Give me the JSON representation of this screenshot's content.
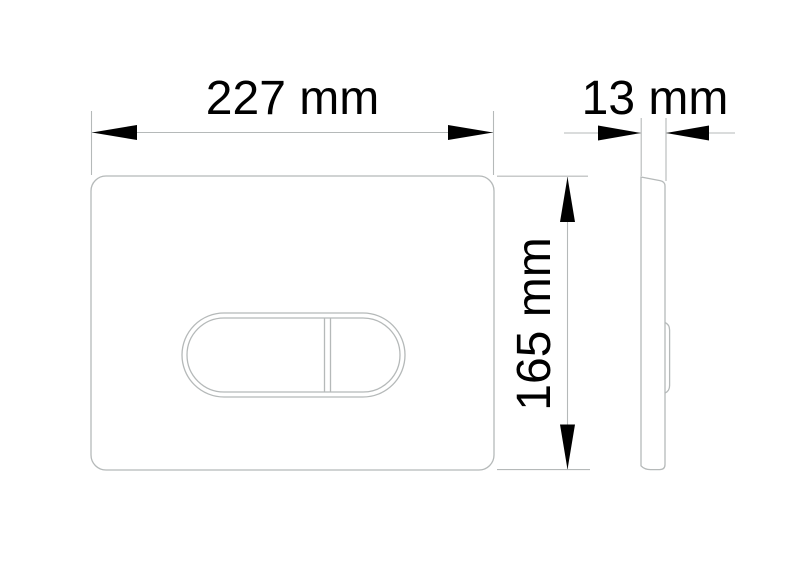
{
  "drawing": {
    "dimensions": {
      "width": {
        "label": "227 mm",
        "value": 227,
        "unit": "mm"
      },
      "depth": {
        "label": "13 mm",
        "value": 13,
        "unit": "mm"
      },
      "height": {
        "label": "165 mm",
        "value": 165,
        "unit": "mm"
      }
    },
    "colors": {
      "line": "#b5b9b9",
      "ink": "#000000",
      "background": "#ffffff"
    }
  }
}
